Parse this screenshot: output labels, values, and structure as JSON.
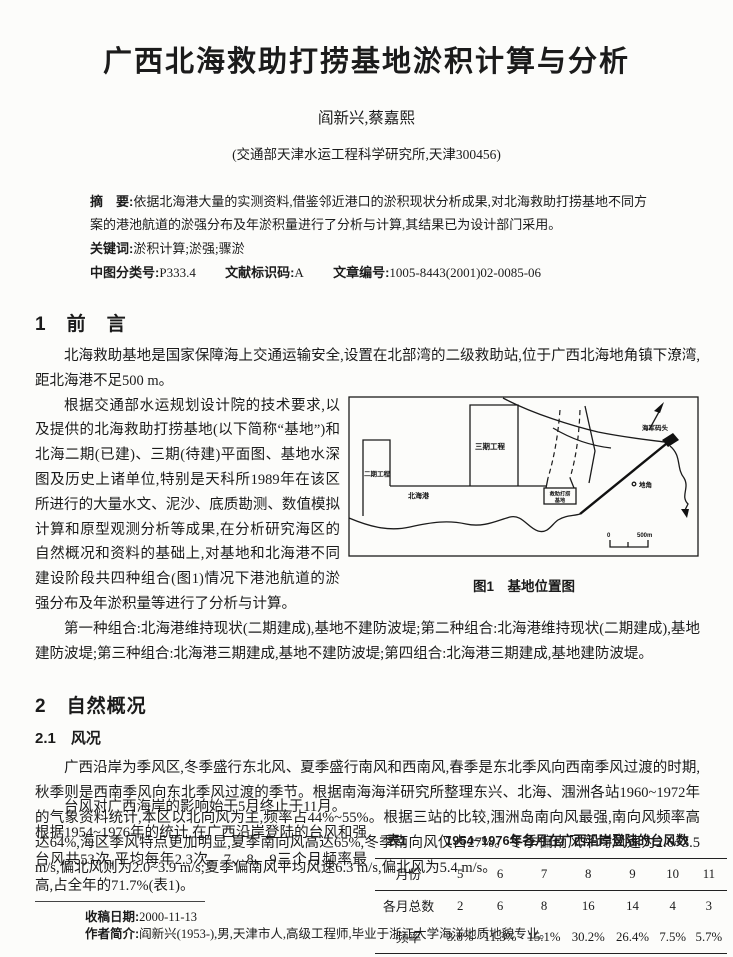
{
  "page": {
    "title": "广西北海救助打捞基地淤积计算与分析",
    "authors": "阎新兴,蔡嘉熙",
    "affiliation": "(交通部天津水运工程科学研究所,天津300456)"
  },
  "meta": {
    "abstract_label": "摘　要:",
    "abstract": "依据北海港大量的实测资料,借鉴邻近港口的淤积现状分析成果,对北海救助打捞基地不同方案的港池航道的淤强分布及年淤积量进行了分析与计算,其结果已为设计部门采用。",
    "keywords_label": "关键词:",
    "keywords": "淤积计算;淤强;骤淤",
    "clc_label": "中图分类号:",
    "clc": "P333.4",
    "doc_code_label": "文献标识码:",
    "doc_code": "A",
    "article_id_label": "文章编号:",
    "article_id": "1005-8443(2001)02-0085-06"
  },
  "section1": {
    "heading": "1　前　言",
    "para1": "北海救助基地是国家保障海上交通运输安全,设置在北部湾的二级救助站,位于广西北海地角镇下潦湾,距北海港不足500 m。",
    "para2": "根据交通部水运规划设计院的技术要求,以及提供的北海救助打捞基地(以下简称“基地”)和北海二期(已建)、三期(待建)平面图、基地水深图及历史上诸单位,特别是天科所1989年在该区所进行的大量水文、泥沙、底质勘测、数值模拟计算和原型观测分析等成果,在分析研究海区的自然概况和资料的基础上,对基地和北海港不同建设阶段共四种组合(图1)情况下港池航道的淤强分布及年淤积量等进行了分析与计算。",
    "para3": "第一种组合:北海港维持现状(二期建成),基地不建防波堤;第二种组合:北海港维持现状(二期建成),基地建防波堤;第三种组合:北海港三期建成,基地不建防波堤;第四组合:北海港三期建成,基地建防波堤。"
  },
  "figure1": {
    "caption": "图1　基地位置图",
    "labels": {
      "phase2": "二期工程",
      "phase3": "三期工程",
      "beihai_port": "北海港",
      "base_line1": "救助打捞",
      "base_line2": "基地",
      "navy_wharf": "海军码头",
      "dijiao": "地角",
      "scale_zero": "0",
      "scale": "500m"
    }
  },
  "section2": {
    "heading": "2　自然概况",
    "sub_heading": "2.1　风况",
    "para1": "广西沿岸为季风区,冬季盛行东北风、夏季盛行南风和西南风,春季是东北季风向西南季风过渡的时期,秋季则是西南季风向东北季风过渡的季节。根据南海海洋研究所整理东兴、北海、涠洲各站1960~1972年的气象资料统计,本区以北向风为主,频率占44%~55%。根据三站的比较,涠洲岛南向风最强,南向风频率高达64%,海区季风特点更加明显,夏季南向风高达65%,冬季南向风仅占27%。冬季偏南风平均风速为2.6~3.5 m/s,偏北风则为2.0~3.9 m/s;夏季偏南风平均风速6.3 m/s,偏北风为5.4 m/s。",
    "para2_lead": "台风对广西海岸的影响始于5月终止于11月。",
    "para2_rest": "根据1954~1976年的统计,在广西沿岸登陆的台风和强台风共53次,平均每年2.3次。7、8、9三个月频率最高,占全年的71.7%(表1)。"
  },
  "table1": {
    "caption_label": "表1",
    "caption": "1954~1976年各月在广西沿岸登陆的台风数",
    "row_headers": {
      "months": "月份",
      "totals": "各月总数",
      "freqs": "频率"
    },
    "months": [
      "5",
      "6",
      "7",
      "8",
      "9",
      "10",
      "11"
    ],
    "totals": [
      "2",
      "6",
      "8",
      "16",
      "14",
      "4",
      "3"
    ],
    "freqs": [
      "3.8%",
      "11.3%",
      "15.1%",
      "30.2%",
      "26.4%",
      "7.5%",
      "5.7%"
    ]
  },
  "footer": {
    "received_label": "收稿日期:",
    "received": "2000-11-13",
    "bio_label": "作者简介:",
    "bio": "阎新兴(1953-),男,天津市人,高级工程师,毕业于浙江大学海洋地质地貌专业。"
  }
}
